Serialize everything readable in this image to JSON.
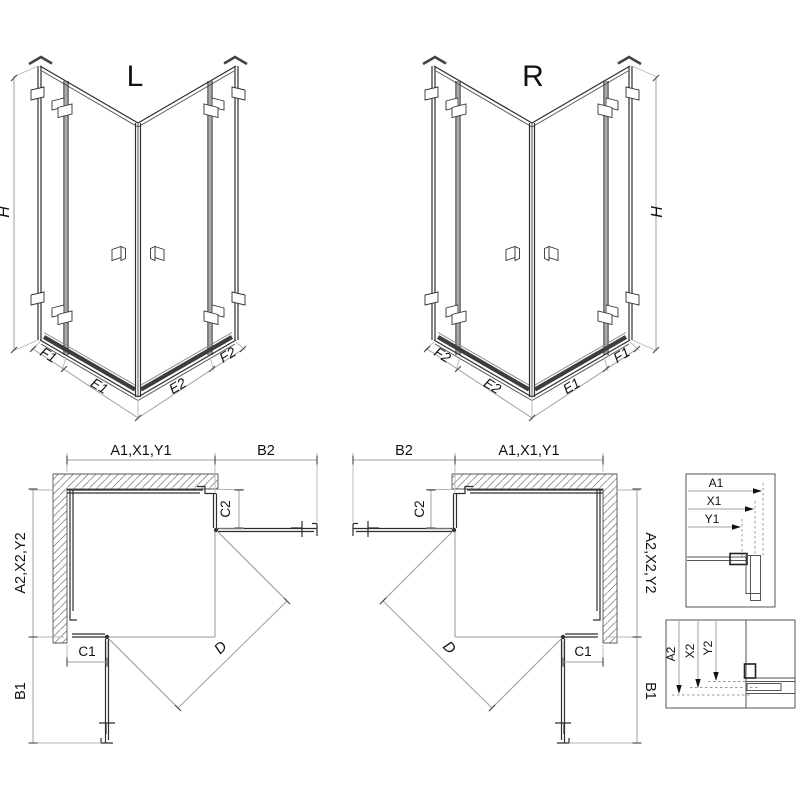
{
  "iso_left": {
    "label": "L",
    "h": "H",
    "f1": "F1",
    "e1": "E1",
    "e2": "E2",
    "f2": "F2"
  },
  "iso_right": {
    "label": "R",
    "h": "H",
    "f2": "F2",
    "e2": "E2",
    "e1": "E1",
    "f1": "F1"
  },
  "plan_left": {
    "width_top": "A1,X1,Y1",
    "door_top": "B2",
    "return_top": "C2",
    "depth_side": "A2,X2,Y2",
    "return_bottom": "C1",
    "door_bottom": "B1",
    "diagonal": "D"
  },
  "plan_right": {
    "width_top": "A1,X1,Y1",
    "door_top": "B2",
    "return_top": "C2",
    "depth_side": "A2,X2,Y2",
    "return_bottom": "C1",
    "door_bottom": "B1",
    "diagonal": "D"
  },
  "detail_width": {
    "a1": "A1",
    "x1": "X1",
    "y1": "Y1"
  },
  "detail_depth": {
    "a2": "A2",
    "x2": "X2",
    "y2": "Y2"
  },
  "colors": {
    "line": "#2e2e2e",
    "dim_line": "#a0a0a0",
    "text": "#111111",
    "hatch": "#888888",
    "seal": "#3d3d3d",
    "background": "#ffffff"
  }
}
